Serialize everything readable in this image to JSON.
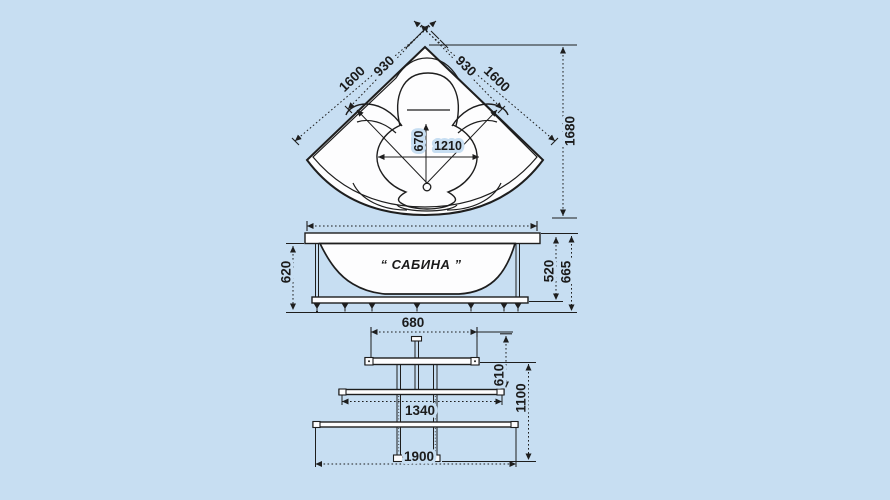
{
  "colors": {
    "background": "#c7def2",
    "line": "#1e1e1e",
    "drawing_fill": "#fdfdfe"
  },
  "product": {
    "name_label": "“ САБИНА ”"
  },
  "top_view": {
    "dims": {
      "edge_left_outer": "1600",
      "edge_left_inner": "930",
      "edge_right_inner": "930",
      "edge_right_outer": "1600",
      "overall_height": "1680",
      "basin_depth": "670",
      "basin_width": "1210"
    }
  },
  "side_view": {
    "dims": {
      "apron_height": "620",
      "frame_height": "520",
      "total_height": "665"
    }
  },
  "frame_view": {
    "dims": {
      "top_bar_length": "680",
      "upper_span": "610",
      "middle_bar_length": "1340",
      "total_span": "1100",
      "bottom_bar_length": "1900"
    }
  }
}
